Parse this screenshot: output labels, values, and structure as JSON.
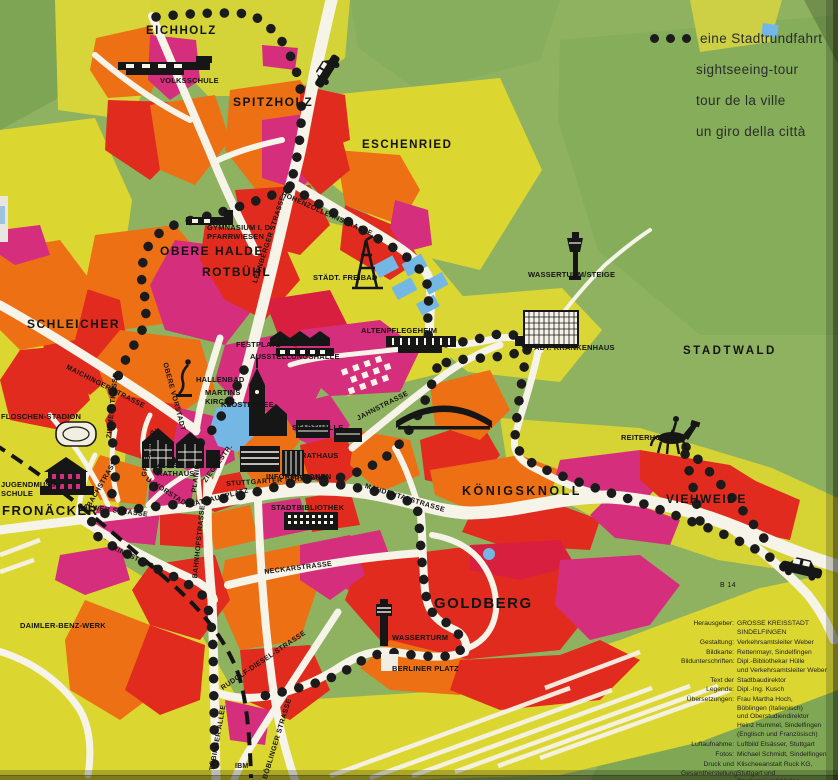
{
  "legend": {
    "items": [
      {
        "label": "eine Stadtrundfahrt"
      },
      {
        "label": "sightseeing-tour"
      },
      {
        "label": "tour de la ville"
      },
      {
        "label": "un giro della città"
      }
    ]
  },
  "districts": [
    {
      "id": "eichholz",
      "label": "EICHHOLZ"
    },
    {
      "id": "spitzholz",
      "label": "SPITZHOLZ"
    },
    {
      "id": "eschenried",
      "label": "ESCHENRIED"
    },
    {
      "id": "obere-halde",
      "label": "OBERE HALDE"
    },
    {
      "id": "rotbuehl",
      "label": "ROTBÜHL"
    },
    {
      "id": "schleicher",
      "label": "SCHLEICHER"
    },
    {
      "id": "fronaecker",
      "label": "FRONÄCKER"
    },
    {
      "id": "koenigsknoll",
      "label": "KÖNIGSKNOLL"
    },
    {
      "id": "viehweide",
      "label": "VIEHWEIDE"
    },
    {
      "id": "goldberg",
      "label": "GOLDBERG"
    },
    {
      "id": "stadtwald",
      "label": "STADTWALD"
    }
  ],
  "streets": [
    {
      "label": "HOHENZOLLERNSTRASSE"
    },
    {
      "label": "LEONBERGER STRASSE"
    },
    {
      "label": "MAICHINGER STRASSE"
    },
    {
      "label": "OBERE VORSTADT"
    },
    {
      "label": "U. VORSTADT"
    },
    {
      "label": "GRABENSTR."
    },
    {
      "label": "ZIMMERSTRASSE"
    },
    {
      "label": "BACHSTRASSE"
    },
    {
      "label": "CALWER STRASSE"
    },
    {
      "label": "RINGSTRASSE"
    },
    {
      "label": "BAHNHOFSTRASSE"
    },
    {
      "label": "NECKARSTRASSE"
    },
    {
      "label": "RUDOLF-DIESEL-STRASSE"
    },
    {
      "label": "TÜBINGER ALLEE"
    },
    {
      "label": "BÖBLINGER STRASSE"
    },
    {
      "label": "STUTTGARTER STRASSE"
    },
    {
      "label": "MAHDENTALSTRASSE"
    },
    {
      "label": "JAHNSTRASSE"
    },
    {
      "label": "PLANIE"
    },
    {
      "label": "ZIEGELSTR."
    },
    {
      "label": "RATHAUSPLATZ"
    },
    {
      "label": "B 14"
    }
  ],
  "pois": [
    {
      "label": "VOLKSSCHULE"
    },
    {
      "label": "GYMNASIUM I. D.\nPFARRWIESEN"
    },
    {
      "label": "STÄDT. FREIBAD"
    },
    {
      "label": "WASSERTURM/STEIGE"
    },
    {
      "label": "ALTENPFLEGEHEIM"
    },
    {
      "label": "STÄDT. KRANKENHAUS"
    },
    {
      "label": "FESTPLATZ"
    },
    {
      "label": "AUSSTELLUNGSHALLE"
    },
    {
      "label": "HALLENBAD"
    },
    {
      "label": "MARTINS\nKIRCHE"
    },
    {
      "label": "KLOSTERSEE"
    },
    {
      "label": "STADTHALLE"
    },
    {
      "label": "RATHAUS"
    },
    {
      "label": "ALTES\nRATHAUS"
    },
    {
      "label": "INFORMATIONEN"
    },
    {
      "label": "STADTBIBLIOTHEK"
    },
    {
      "label": "FLOSCHEN-STADION"
    },
    {
      "label": "JUGENDMUSIK-\nSCHULE"
    },
    {
      "label": "DAIMLER-BENZ-WERK"
    },
    {
      "label": "WASSERTURM"
    },
    {
      "label": "BERLINER PLATZ"
    },
    {
      "label": "IBM"
    },
    {
      "label": "REITERHOF"
    }
  ],
  "credits": {
    "rows": [
      {
        "label": "Herausgeber:",
        "value": "GROSSE KREISSTADT\nSINDELFINGEN"
      },
      {
        "label": "Gestaltung:",
        "value": "Verkehrsamtsleiter Weber"
      },
      {
        "label": "Bildkarte:",
        "value": "Rettenmayr, Sindelfingen"
      },
      {
        "label": "Bildunterschriften:",
        "value": "Dipl.-Bibliothekar Hülle\nund Verkehrsamtsleiter Weber"
      },
      {
        "label": "Text der Legende:",
        "value": "Stadtbaudirektor\nDipl.-Ing. Kusch"
      },
      {
        "label": "Übersetzungen:",
        "value": "Frau Martha Hoch,\nBöblingen (Italienisch)\nund Oberstudiendirektor\nHeinz Hummel, Sindelfingen\n(Englisch und Französisch)"
      },
      {
        "label": "Luftaufnahme:",
        "value": "Luftbild Elsässer, Stuttgart"
      },
      {
        "label": "Fotos:",
        "value": "Michael Schmidt, Sindelfingen"
      },
      {
        "label": "Druck und\nGesamtherstellung:",
        "value": "Klischeeanstalt Ruck KG,\nStuttgart und\nDruckerei und Verlag\nAdolf Röhm, Sindelfingen"
      },
      {
        "label": "Auflage:",
        "value": "40 000"
      }
    ]
  },
  "colors": {
    "map_green": "#8fb260",
    "forest_green": "#7da553",
    "field_yellow": "#dcd631",
    "block_orange": "#ee7014",
    "block_red": "#e12b1e",
    "block_magenta": "#d42e7c",
    "block_crimson": "#d81f3f",
    "road_white": "#f6f3e8",
    "water_blue": "#74b6e4",
    "route_black": "#1b1b1b"
  }
}
